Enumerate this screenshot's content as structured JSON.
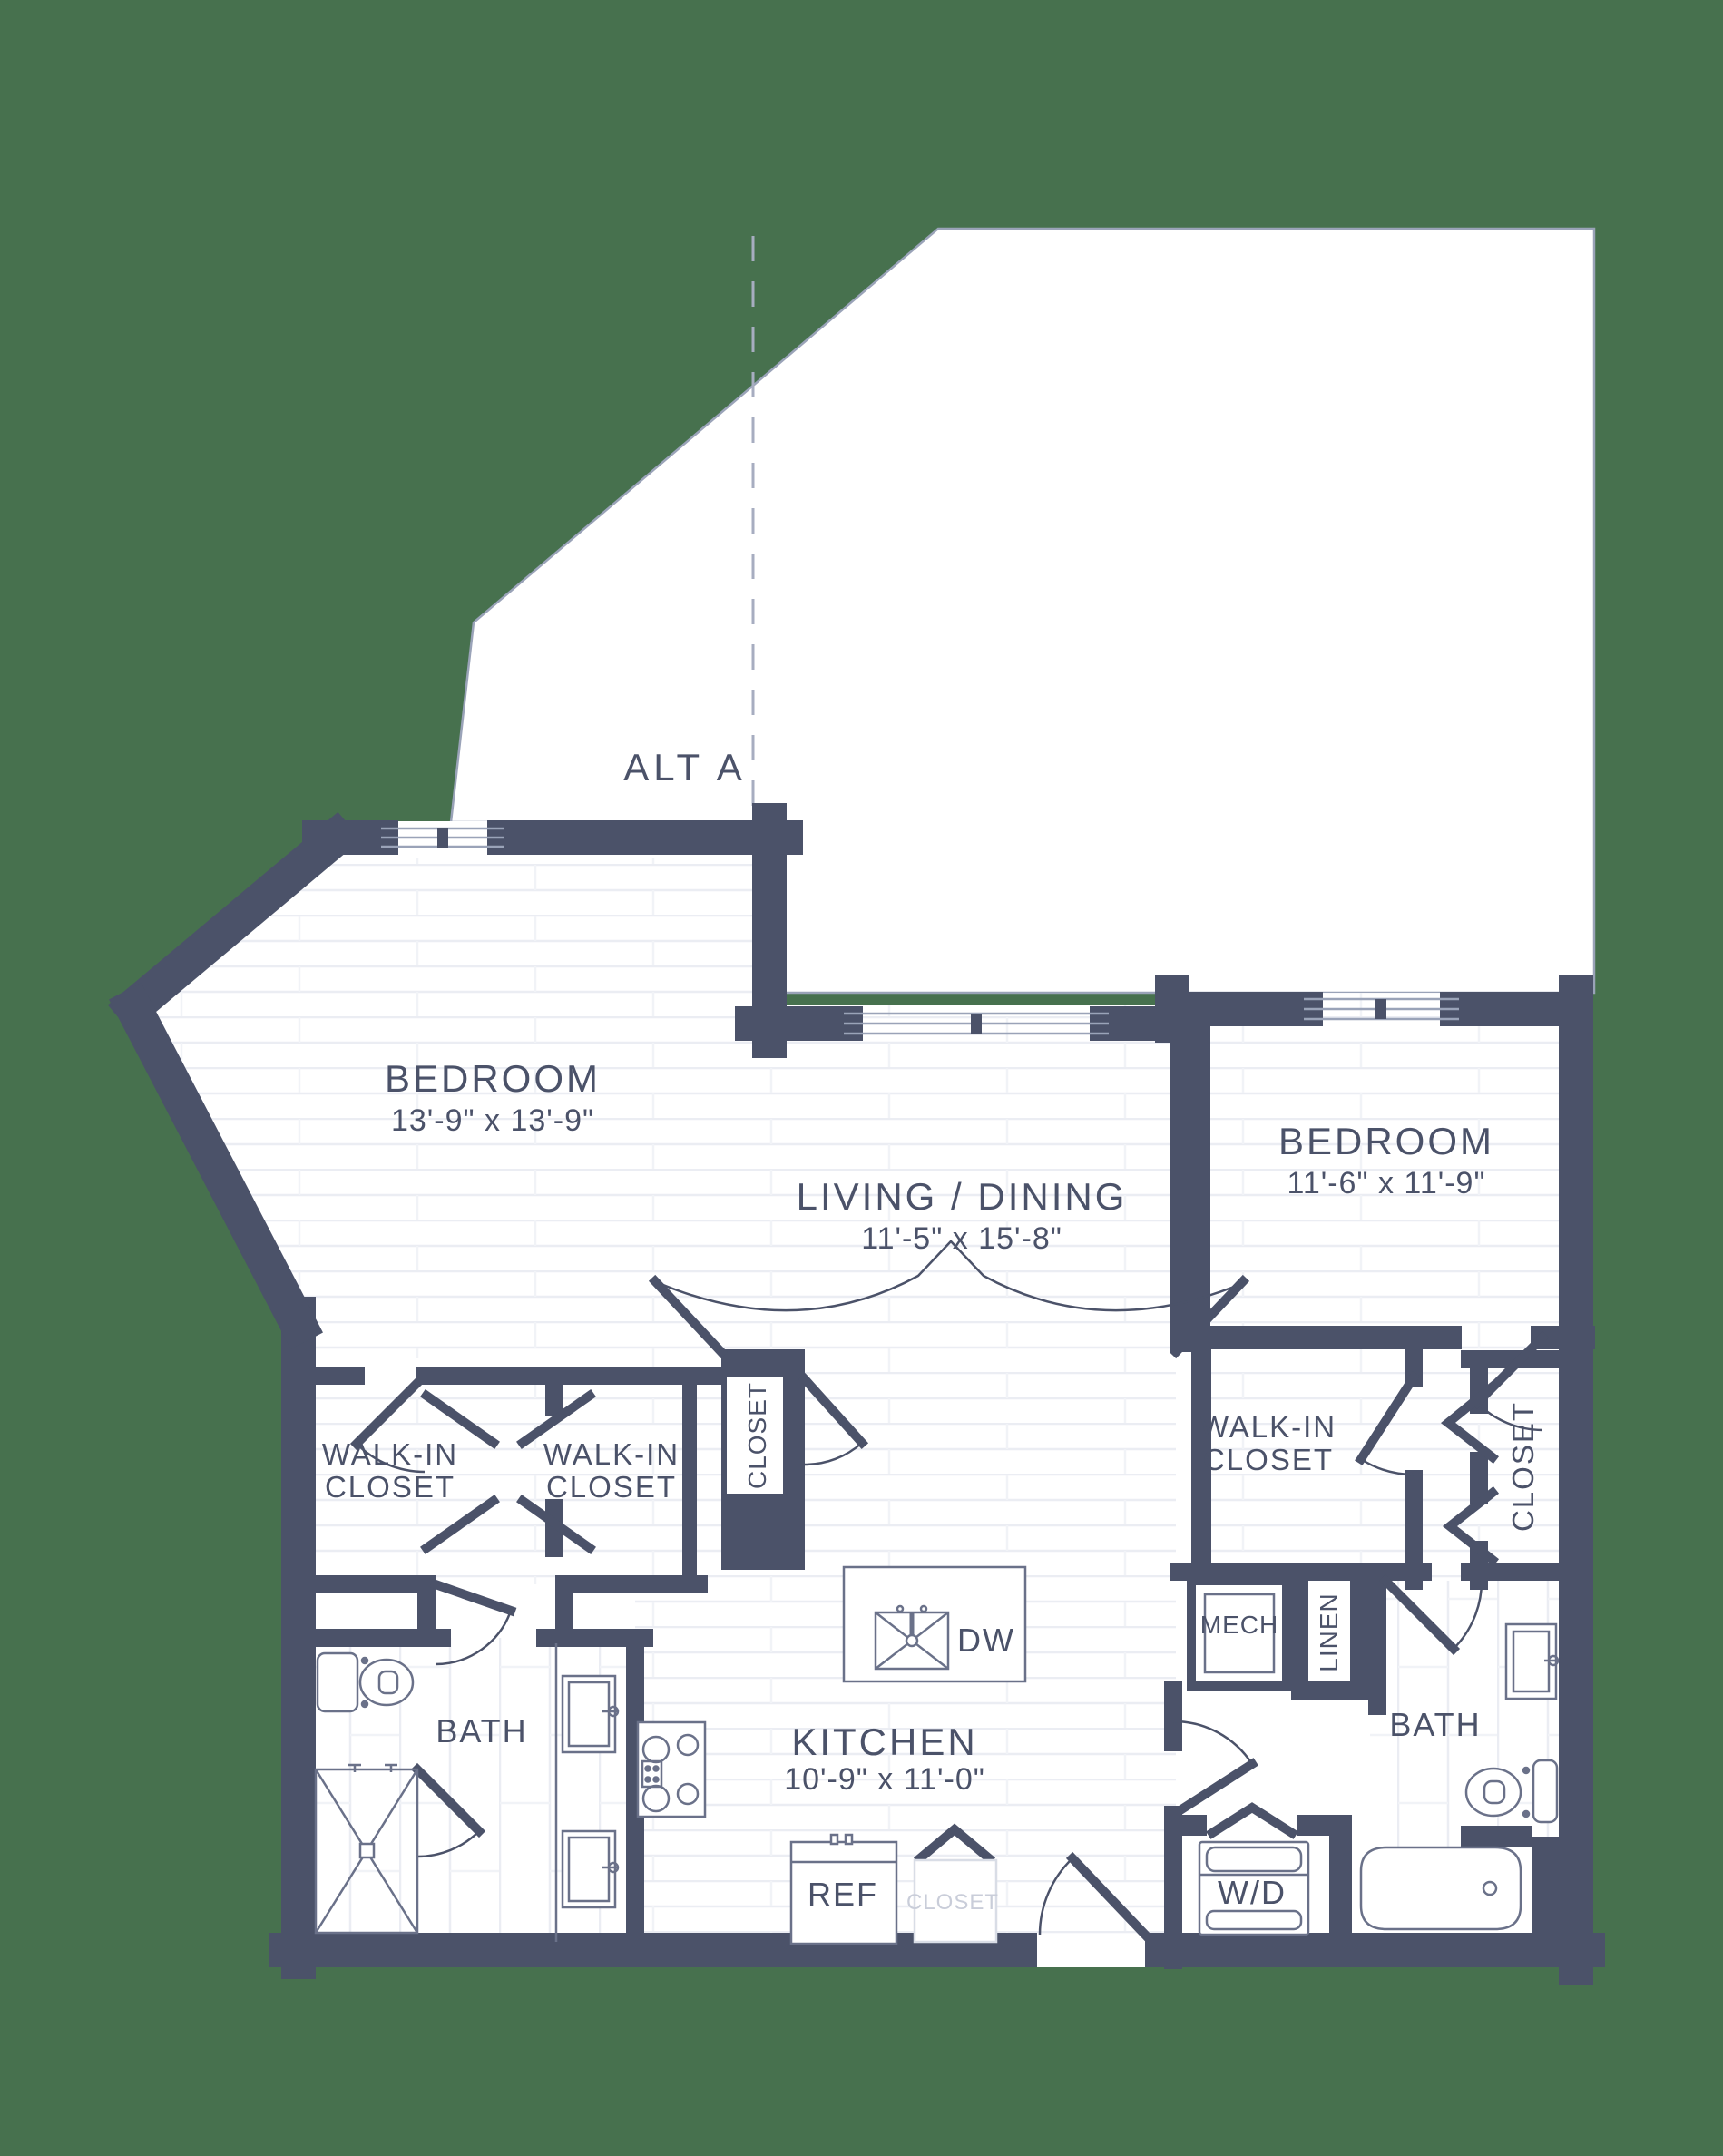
{
  "plan_type": "apartment-floor-plan",
  "colors": {
    "background": "#47714E",
    "wall": "#4B5269",
    "text": "#4B5269",
    "faint_text": "#C9CDD9",
    "floor_line": "#EBEDF3",
    "fixture_outline": "#6A7189",
    "alt_outline": "#9AA3B8"
  },
  "alt_area": {
    "label": "ALT A"
  },
  "rooms": {
    "bedroom1": {
      "name": "BEDROOM",
      "dims": "13'-9\" x 13'-9\""
    },
    "living": {
      "name": "LIVING / DINING",
      "dims": "11'-5\" x 15'-8\""
    },
    "bedroom2": {
      "name": "BEDROOM",
      "dims": "11'-6\" x 11'-9\""
    },
    "kitchen": {
      "name": "KITCHEN",
      "dims": "10'-9\" x 11'-0\""
    },
    "bath1": {
      "name": "BATH"
    },
    "bath2": {
      "name": "BATH"
    }
  },
  "closets": {
    "walkin_line1": "WALK-IN",
    "walkin_line2": "CLOSET",
    "hall_closet": "CLOSET",
    "bedroom2_closet": "CLOSET",
    "entry_closet": "CLOSET"
  },
  "utility": {
    "mech": "MECH",
    "linen": "LINEN",
    "washer_dryer": "W/D",
    "dishwasher": "DW",
    "refrigerator": "REF"
  }
}
